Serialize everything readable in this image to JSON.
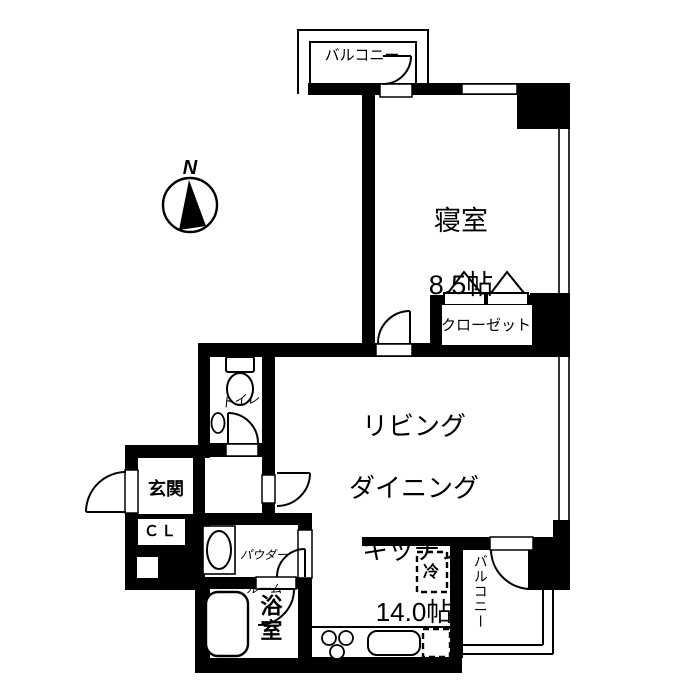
{
  "compass": {
    "north": "N"
  },
  "labels": {
    "balcony_north": "バルコニー",
    "bedroom_name": "寝室",
    "bedroom_size": "8.5帖",
    "closet": "クローゼット",
    "ldk_line1": "リビング",
    "ldk_line2": "ダイニング",
    "ldk_line3": "キッチン",
    "ldk_size": "14.0帖",
    "toilet": "トイレ",
    "entrance": "玄関",
    "shoe_closet": "ＣＬ",
    "powder_line1": "パウダー",
    "powder_line2": "ルーム",
    "bathroom": "浴室",
    "refrigerator": "冷",
    "balcony_south": "バルコニー"
  },
  "colors": {
    "wall": "#000000",
    "background": "#ffffff",
    "line": "#000000"
  }
}
